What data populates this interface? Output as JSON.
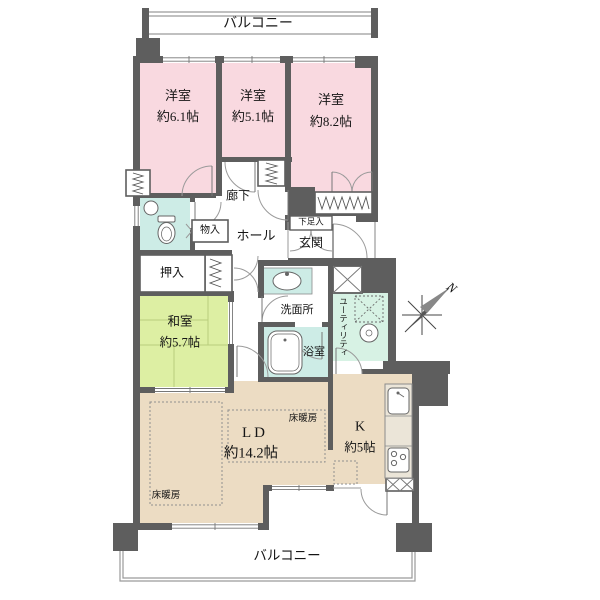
{
  "floorplan": {
    "balcony_top_label": "バルコニー",
    "balcony_bottom_label": "バルコニー",
    "rooms": {
      "bedroom1": {
        "name": "洋室",
        "area": "約6.1帖"
      },
      "bedroom2": {
        "name": "洋室",
        "area": "約5.1帖"
      },
      "bedroom3": {
        "name": "洋室",
        "area": "約8.2帖"
      },
      "washitsu": {
        "name": "和室",
        "area": "約5.7帖"
      },
      "living_dining": {
        "name": "LD",
        "area": "約14.2帖"
      },
      "kitchen": {
        "name": "K",
        "area": "約5帖"
      }
    },
    "labels": {
      "corridor": "廊下",
      "hall": "ホール",
      "storage": "物入",
      "oshiire": "押入",
      "shoe_cabinet": "下足入",
      "entrance": "玄関",
      "washroom": "洗面所",
      "bathroom": "浴室",
      "utility": "ユーティリティ",
      "floor_heating": "床暖房",
      "compass_north": "N"
    },
    "colors": {
      "wall": "#5e5e5e",
      "bedroom_pink": "#f9d9e0",
      "tatami_green": "#ddefa3",
      "wet_area_cyan": "#cdece6",
      "utility_mint": "#d7f2e4",
      "living_beige": "#ecdcc3"
    }
  }
}
